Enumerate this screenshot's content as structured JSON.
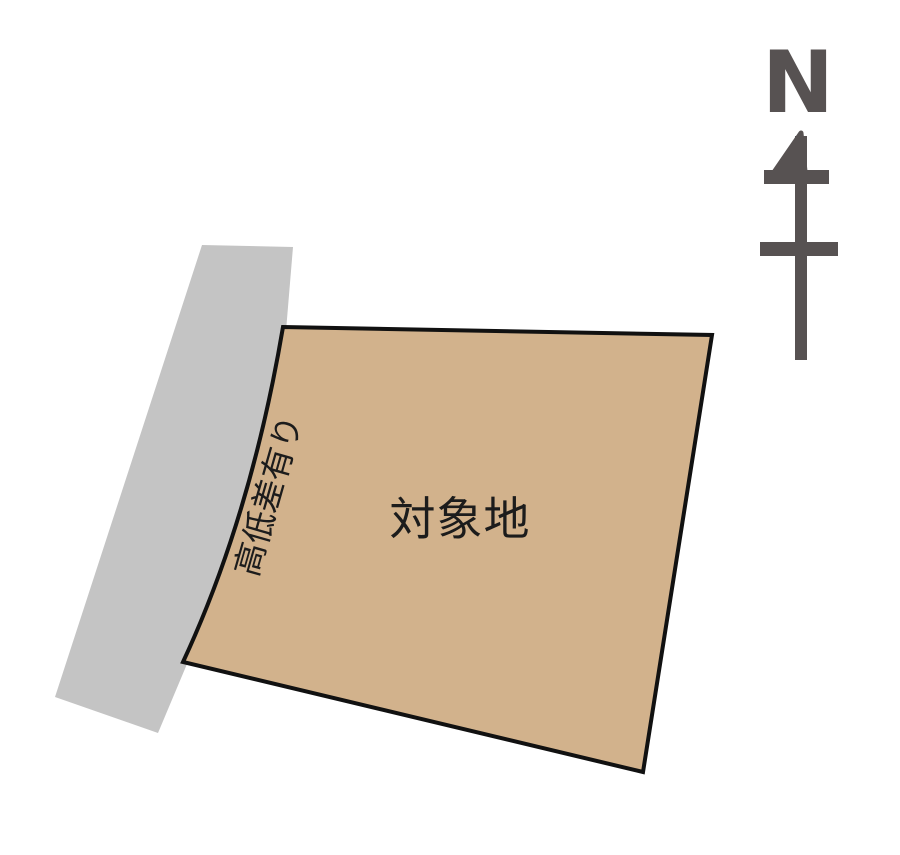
{
  "plan": {
    "site": {
      "label": "対象地"
    },
    "slope_note": {
      "label": "高低差有り"
    },
    "compass": {
      "label": "N"
    },
    "colors": {
      "site_fill": "#d2b28c",
      "outline": "#111111",
      "road_fill": "#c4c4c4",
      "compass": "#575252",
      "text": "#1c1c1c",
      "background": "#ffffff"
    }
  }
}
